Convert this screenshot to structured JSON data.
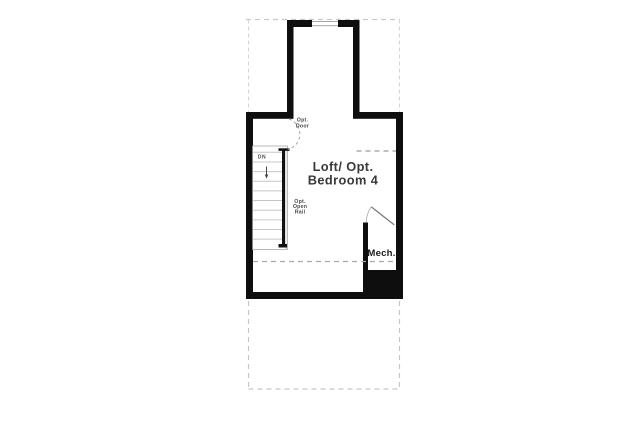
{
  "plan": {
    "room_label_line1": "Loft/ Opt.",
    "room_label_line2": "Bedroom 4",
    "opt_door_line1": "Opt.",
    "opt_door_line2": "Door",
    "stairs_direction": "DN",
    "opt_rail_line1": "Opt.",
    "opt_rail_line2": "Open",
    "opt_rail_line3": "Rail",
    "mech_label": "Mech.",
    "colors": {
      "wall": "#0e0e0e",
      "outline_dashed": "#c7c7c7",
      "interior_dashed": "#9a9a9a",
      "stair_tread": "#c6c6c6",
      "door_swing": "#a6a6a6",
      "title_text": "#3a3a3a",
      "background": "#ffffff"
    }
  }
}
